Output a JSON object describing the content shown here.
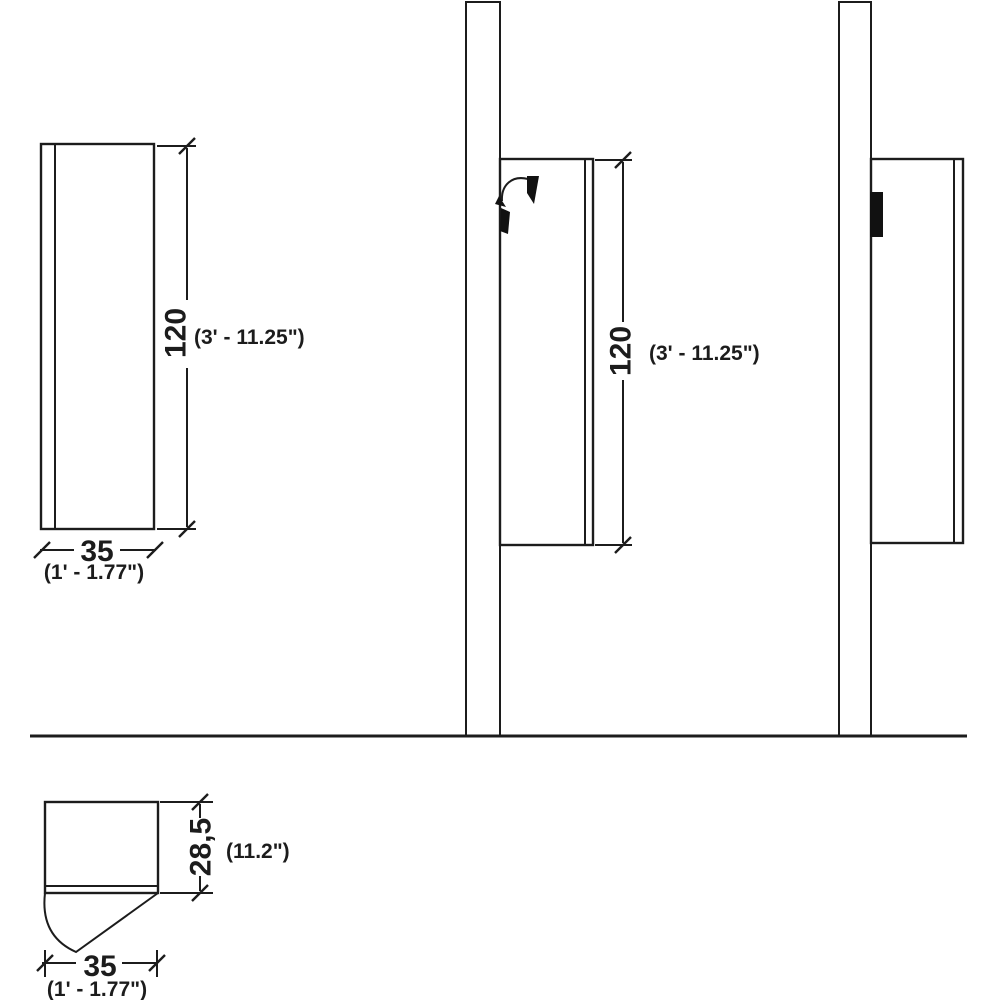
{
  "drawing": {
    "front_view": {
      "height": "120",
      "height_alt": "(3' - 11.25\")",
      "width": "35",
      "width_alt": "(1' - 1.77\")"
    },
    "side_view": {
      "height": "120",
      "height_alt": "(3' - 11.25\")"
    },
    "section_view": {
      "depth": "28,5",
      "depth_alt": "(11.2\")",
      "width": "35",
      "width_alt": "(1' - 1.77\")"
    },
    "colors": {
      "line": "#1c1c1c",
      "background": "#ffffff"
    }
  }
}
